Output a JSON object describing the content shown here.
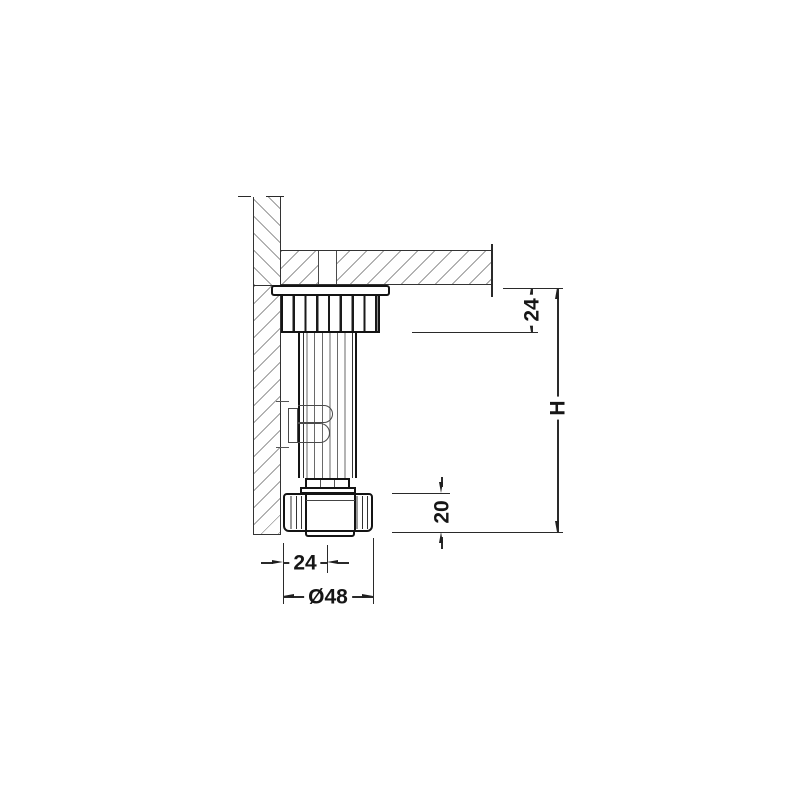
{
  "figure": {
    "type": "technical-section-drawing",
    "subject": "Adjustable plinth foot mounted under cabinet bottom panel, side section view"
  },
  "dims": {
    "socket_height": {
      "label": "24",
      "orientation": "vertical"
    },
    "total_height": {
      "label": "H",
      "orientation": "vertical"
    },
    "base_height": {
      "label": "20",
      "orientation": "vertical"
    },
    "edge_to_axis": {
      "label": "24",
      "orientation": "horizontal"
    },
    "base_diameter": {
      "label": "Ø48",
      "orientation": "horizontal"
    }
  },
  "colors": {
    "background": "#ffffff",
    "outline": "#141414",
    "hatch": "#9a9a9a",
    "dimension": "#1f1f1f"
  }
}
